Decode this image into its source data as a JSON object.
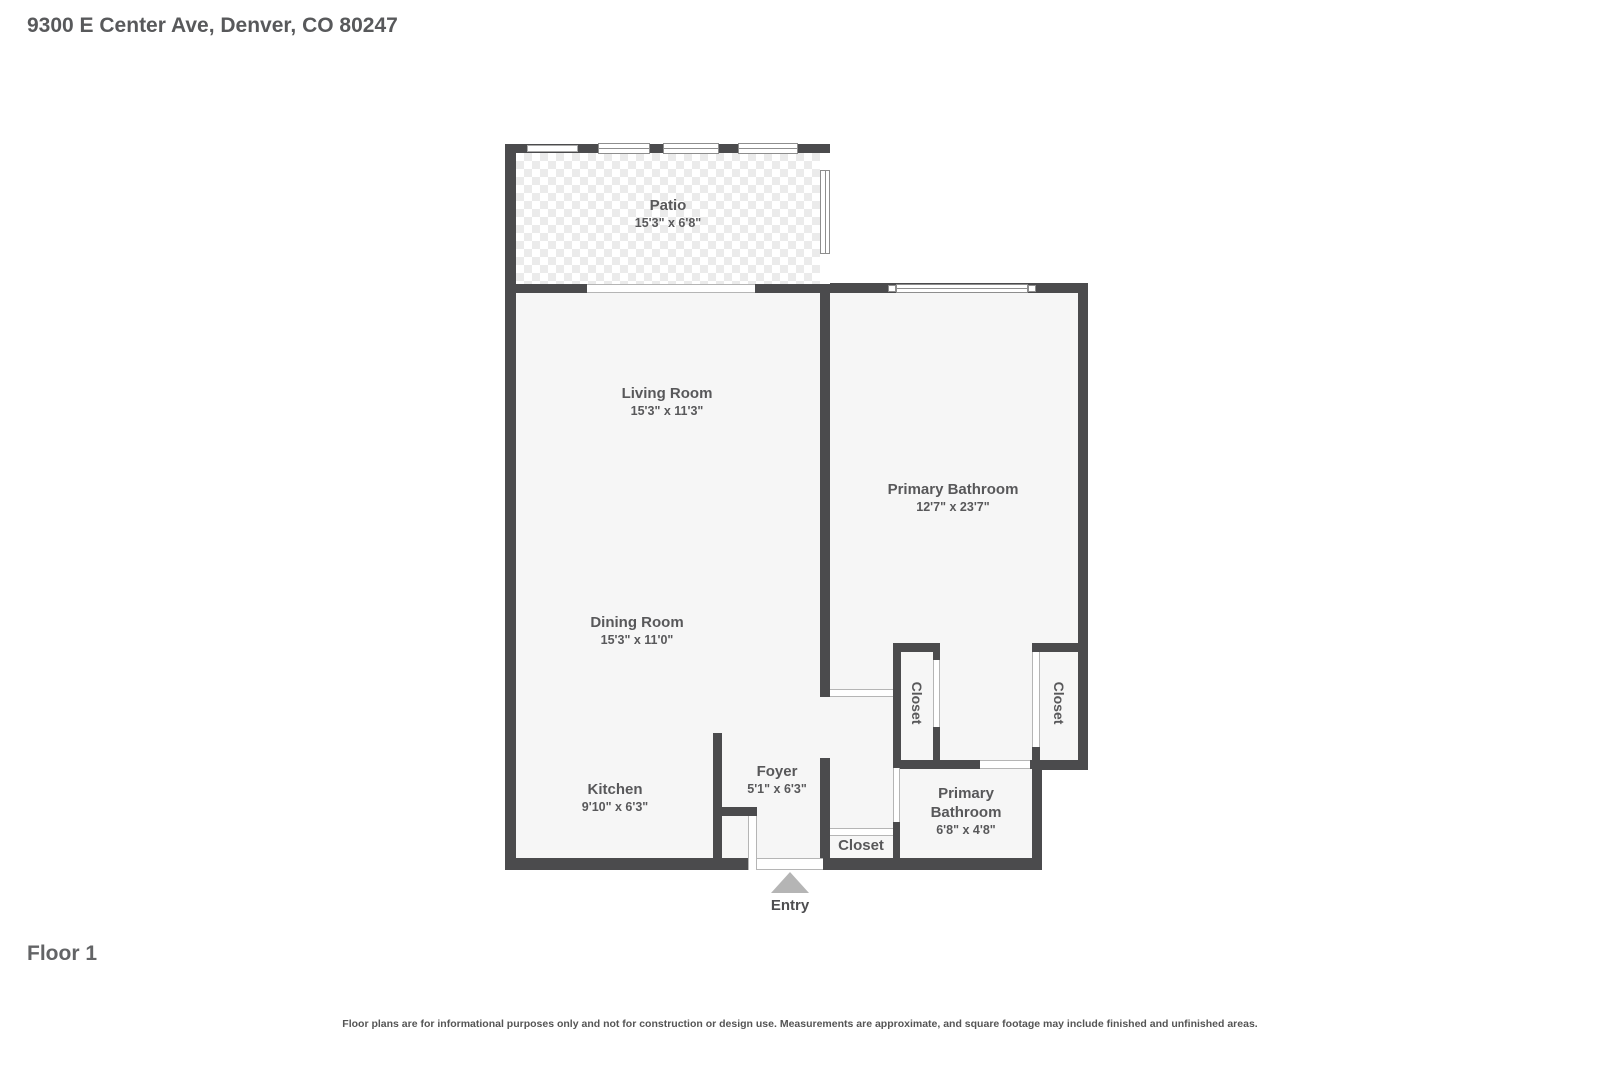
{
  "header": {
    "address": "9300 E Center Ave, Denver, CO 80247"
  },
  "footer": {
    "floor_label": "Floor 1",
    "disclaimer": "Floor plans are for informational purposes only and not for construction or design use. Measurements are approximate, and square footage may include finished and unfinished areas."
  },
  "colors": {
    "wall": "#4b4b4d",
    "room_fill": "#f6f6f6",
    "label_text": "#58585a",
    "entry_arrow": "#b5b5b5",
    "background": "#ffffff"
  },
  "floorplan": {
    "entry_label": "Entry",
    "rooms": {
      "patio": {
        "name": "Patio",
        "dims": "15'3\" x 6'8\""
      },
      "living_room": {
        "name": "Living Room",
        "dims": "15'3\" x 11'3\""
      },
      "dining_room": {
        "name": "Dining Room",
        "dims": "15'3\" x 11'0\""
      },
      "kitchen": {
        "name": "Kitchen",
        "dims": "9'10\" x 6'3\""
      },
      "foyer": {
        "name": "Foyer",
        "dims": "5'1\" x 6'3\""
      },
      "primary_bathroom_large": {
        "name": "Primary Bathroom",
        "dims": "12'7\" x 23'7\""
      },
      "primary_bathroom_small": {
        "name": "Primary Bathroom",
        "dims": "6'8\" x 4'8\""
      },
      "closet_left": {
        "name": "Closet"
      },
      "closet_right": {
        "name": "Closet"
      },
      "closet_bottom": {
        "name": "Closet"
      }
    }
  }
}
